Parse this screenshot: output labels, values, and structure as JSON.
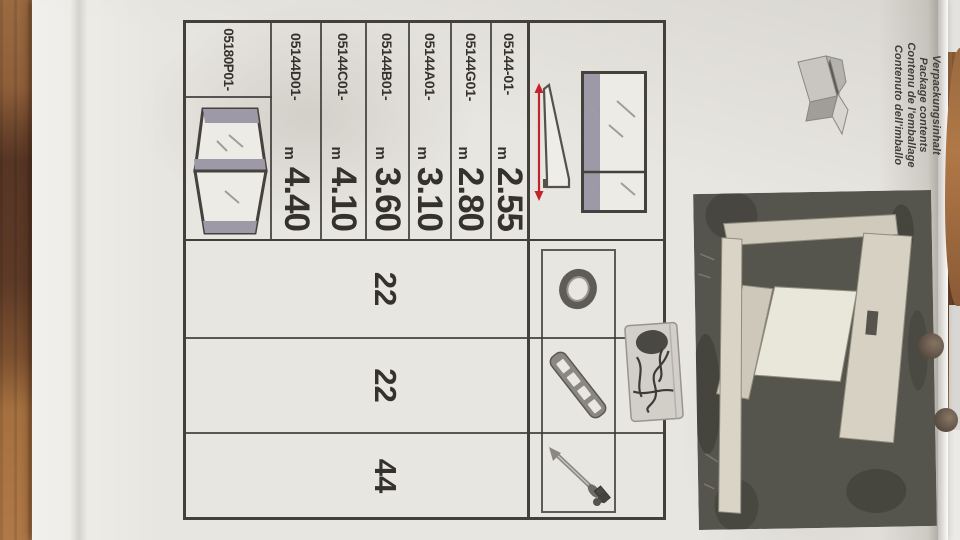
{
  "document": {
    "header": {
      "lines": [
        "Verpackungsinhalt",
        "Package contents",
        "Contenu de l'emballage",
        "Contenuto dell'imballo"
      ]
    },
    "table": {
      "length_rows": [
        {
          "part": "05144-01-",
          "unit": "m",
          "value": "2.55"
        },
        {
          "part": "05144G01-",
          "unit": "m",
          "value": "2.80"
        },
        {
          "part": "05144A01-",
          "unit": "m",
          "value": "3.10"
        },
        {
          "part": "05144B01-",
          "unit": "m",
          "value": "3.60"
        },
        {
          "part": "05144C01-",
          "unit": "m",
          "value": "4.10"
        },
        {
          "part": "05144D01-",
          "unit": "m",
          "value": "4.40"
        }
      ],
      "door_row": {
        "part": "05180P01-"
      },
      "accessories": [
        {
          "icon": "ring-icon",
          "qty": "22"
        },
        {
          "icon": "perforated-strip-icon",
          "qty": "22"
        },
        {
          "icon": "anchor-screw-icon",
          "qty": "44"
        }
      ]
    },
    "colors": {
      "accent_red": "#c2242a",
      "table_line": "#43403c",
      "paper": "#e8e6e0",
      "mirror_gray_band": "#9e99a7",
      "wood_floor": "#7c5130"
    }
  }
}
